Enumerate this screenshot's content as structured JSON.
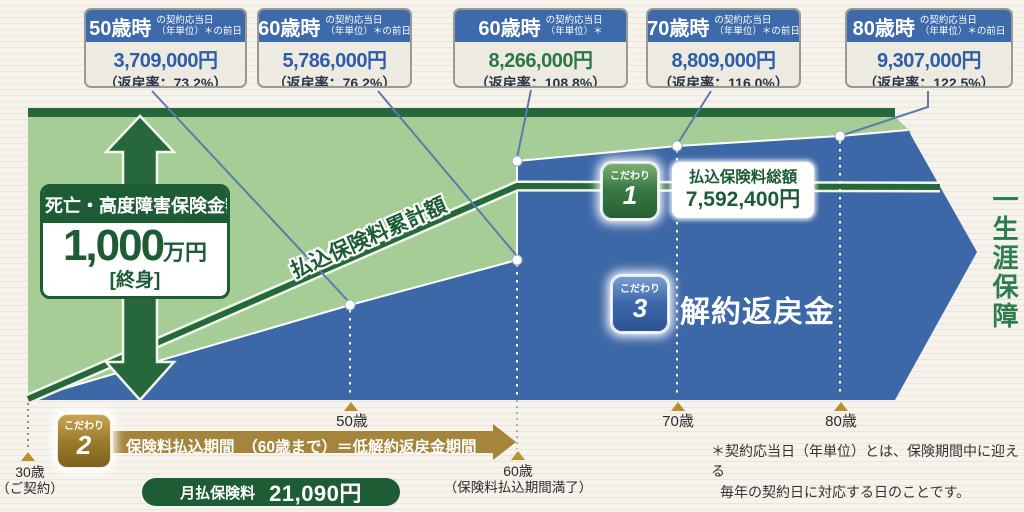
{
  "callouts": [
    {
      "age": "50歳時",
      "note1": "の契約応当日",
      "note2": "（年単位）＊の前日",
      "amount": "3,709,000円",
      "rate": "（返戻率：73.2%）",
      "amount_color": "#2d5ea7"
    },
    {
      "age": "60歳時",
      "note1": "の契約応当日",
      "note2": "（年単位）＊の前日",
      "amount": "5,786,000円",
      "rate": "（返戻率：76.2%）",
      "amount_color": "#2d5ea7"
    },
    {
      "age": "60歳時",
      "note1": "の契約応当日",
      "note2": "（年単位）＊",
      "amount": "8,266,000円",
      "rate": "（返戻率：108.8%）",
      "amount_color": "#2a7a45"
    },
    {
      "age": "70歳時",
      "note1": "の契約応当日",
      "note2": "（年単位）＊の前日",
      "amount": "8,809,000円",
      "rate": "（返戻率：116.0%）",
      "amount_color": "#2d5ea7"
    },
    {
      "age": "80歳時",
      "note1": "の契約応当日",
      "note2": "（年単位）＊の前日",
      "amount": "9,307,000円",
      "rate": "（返戻率：122.5%）",
      "amount_color": "#2d5ea7"
    }
  ],
  "death_benefit": {
    "title": "死亡・高度障害保険金額",
    "amount": "1,000",
    "unit": "万円",
    "term": "[終身]"
  },
  "premium_line_label": "払込保険料累計額",
  "kodawari1": {
    "badge_small": "こだわり",
    "badge_num": "1",
    "title": "払込保険料総額",
    "amount": "7,592,400円"
  },
  "kodawari2": {
    "badge_small": "こだわり",
    "badge_num": "2",
    "band_text": "保険料払込期間　（60歳まで）＝低解約返戻金期間"
  },
  "kodawari3": {
    "badge_small": "こだわり",
    "badge_num": "3",
    "label": "解約返戻金"
  },
  "lifetime_label": "一生涯保障",
  "monthly": {
    "label": "月払保険料",
    "amount": "21,090円"
  },
  "timeline": {
    "age30": "30歳",
    "age30_sub": "（ご契約）",
    "age50": "50歳",
    "age60": "60歳",
    "age60_sub": "（保険料払込期間満了）",
    "age70": "70歳",
    "age80": "80歳"
  },
  "footnote_line1": "＊契約応当日（年単位）とは、保険期間中に迎える",
  "footnote_line2": "毎年の契約日に対応する日のことです。",
  "colors": {
    "light_green_area": "#a6cd96",
    "dark_green": "#26683c",
    "blue_area": "#3d68a7",
    "callout_header_blue": "#3c6aab",
    "gold": "#a5843b",
    "lifetime_green": "#2e7d4f"
  },
  "chart_data": {
    "type": "area",
    "title": "解約返戻金の推移（低解約返戻金型終身保険）",
    "x_ages": [
      30,
      50,
      60,
      60,
      70,
      80
    ],
    "surrender_values_yen": [
      0,
      3709000,
      5786000,
      8266000,
      8809000,
      9307000
    ],
    "return_rates_pct": [
      null,
      73.2,
      76.2,
      108.8,
      116.0,
      122.5
    ],
    "total_paid_premium_yen": 7592400,
    "death_benefit": "1,000万円（終身）",
    "monthly_premium_yen": 21090,
    "payment_period": "保険料払込期間（60歳まで）＝低解約返戻金期間"
  }
}
